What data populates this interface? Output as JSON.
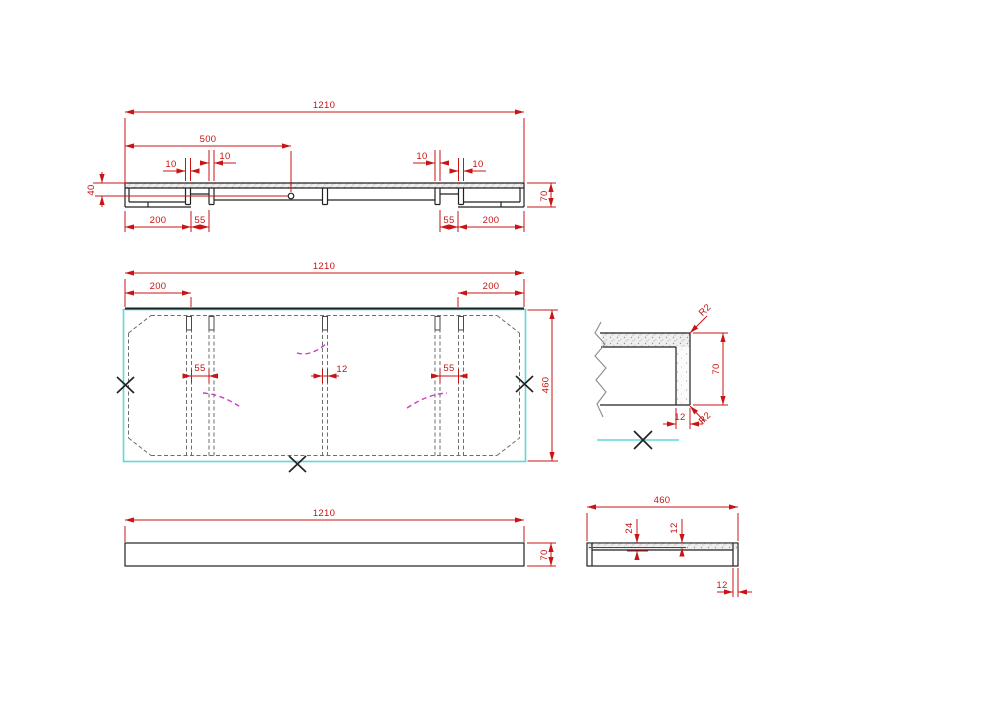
{
  "drawing_type": "cad-orthographic-views",
  "colors": {
    "dimension": "#c81414",
    "outline": "#222222",
    "hidden_line": "#6e6e6e",
    "edge_highlight": "#5fd8d8",
    "bend_line": "#c93ec9",
    "break_line": "#8a8a8a",
    "background": "#ffffff"
  },
  "labels": {
    "section": {
      "overall": "1210",
      "hole_x": "500",
      "slot_a": "10",
      "slot_b": "10",
      "slot_c": "10",
      "slot_d": "10",
      "hole_y": "40",
      "height": "70",
      "end_left": "200",
      "gap_left": "55",
      "gap_right": "55",
      "end_right": "200"
    },
    "plan": {
      "overall": "1210",
      "end_left": "200",
      "end_right": "200",
      "width": "460",
      "gap_left": "55",
      "rib": "12",
      "gap_right": "55"
    },
    "front": {
      "length": "1210",
      "height": "70"
    },
    "detail": {
      "radius_top": "R2",
      "radius_bottom": "R2",
      "height": "70",
      "thickness": "12"
    },
    "side": {
      "width": "460",
      "inset_a": "24",
      "inset_b": "12",
      "thickness": "12"
    }
  }
}
